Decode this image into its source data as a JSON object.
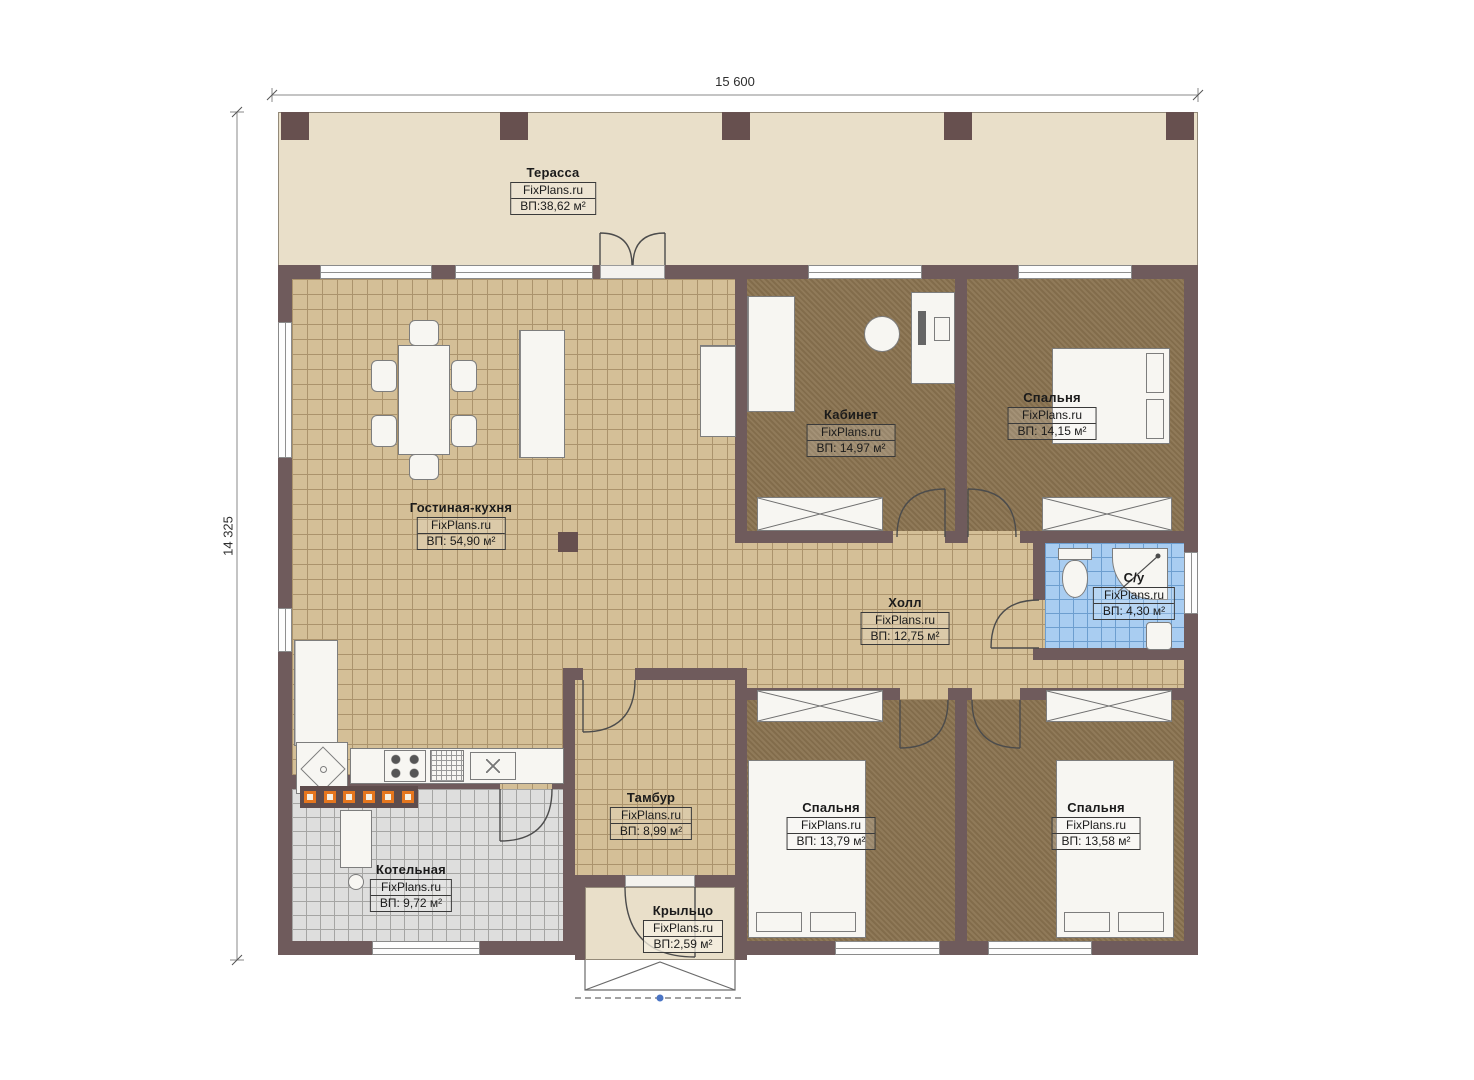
{
  "branding": "FixPlans.ru",
  "dimensions": {
    "width_label": "15 600",
    "height_label": "14 325"
  },
  "rooms": [
    {
      "key": "terrace",
      "name": "Терасса",
      "area": "ВП:38,62 м²"
    },
    {
      "key": "living",
      "name": "Гостиная-кухня",
      "area": "ВП: 54,90 м²"
    },
    {
      "key": "office",
      "name": "Кабинет",
      "area": "ВП: 14,97 м²"
    },
    {
      "key": "bedroom1",
      "name": "Спальня",
      "area": "ВП: 14,15 м²"
    },
    {
      "key": "bathroom",
      "name": "С/у",
      "area": "ВП: 4,30 м²"
    },
    {
      "key": "hall",
      "name": "Холл",
      "area": "ВП: 12,75 м²"
    },
    {
      "key": "vestibule",
      "name": "Тамбур",
      "area": "ВП: 8,99 м²"
    },
    {
      "key": "bedroom2",
      "name": "Спальня",
      "area": "ВП: 13,79 м²"
    },
    {
      "key": "bedroom3",
      "name": "Спальня",
      "area": "ВП: 13,58 м²"
    },
    {
      "key": "boiler",
      "name": "Котельная",
      "area": "ВП: 9,72 м²"
    },
    {
      "key": "porch",
      "name": "Крыльцо",
      "area": "ВП:2,59 м²"
    }
  ],
  "colors": {
    "wall": "#6f5b5c",
    "terrace_floor": "#e9dfc9",
    "tile_tan": "#d4bf97",
    "carpet": "#8a7350",
    "tile_blue": "#a9cdf1",
    "tile_gray": "#dededd",
    "heater_orange": "#e5761e",
    "step_marker_blue": "#4a74c4"
  }
}
